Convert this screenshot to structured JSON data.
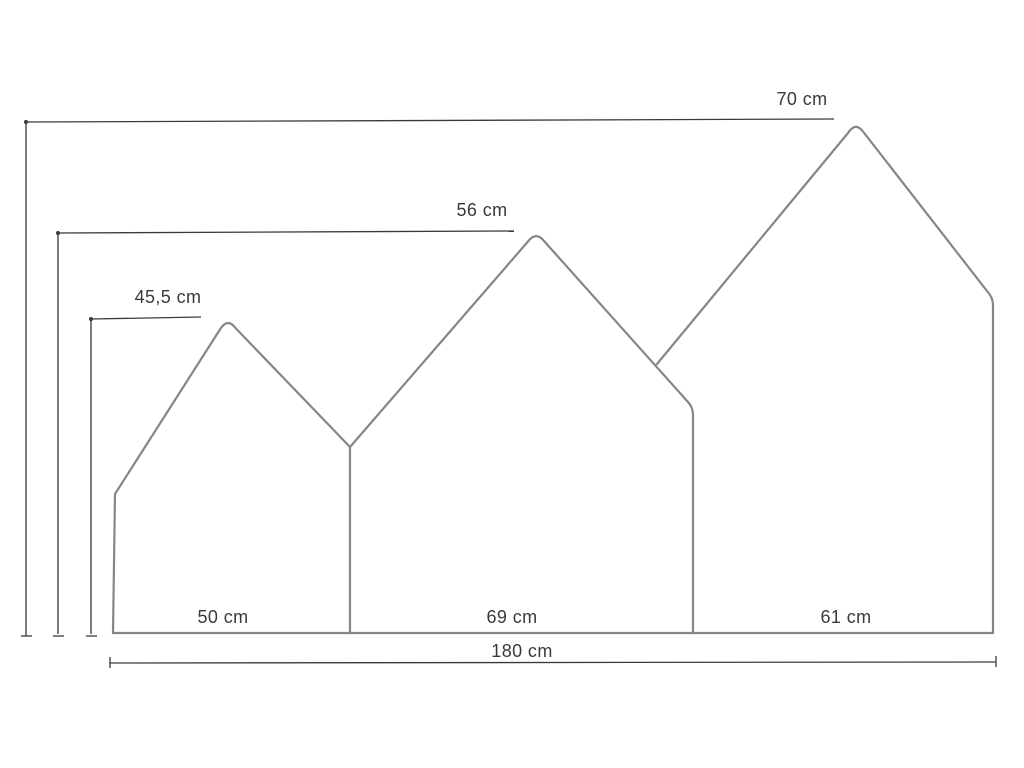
{
  "diagram": {
    "kind": "product-dimension-diagram",
    "units": "cm",
    "labels": {
      "right_house_height": "70 cm",
      "middle_house_height": "56 cm",
      "left_house_height": "45,5 cm",
      "left_house_width": "50 cm",
      "middle_house_width": "69 cm",
      "right_house_width": "61 cm",
      "total_width": "180 cm"
    },
    "values": {
      "right_house_height_cm": 70,
      "middle_house_height_cm": 56,
      "left_house_height_cm": 45.5,
      "left_house_width_cm": 50,
      "middle_house_width_cm": 69,
      "right_house_width_cm": 61,
      "total_width_cm": 180
    },
    "colors": {
      "background": "#ffffff",
      "outline": "#868686",
      "dimension_line": "#3a3a3a",
      "dimension_line_gray": "#7b7b7b",
      "text": "#3a3a3a"
    }
  }
}
